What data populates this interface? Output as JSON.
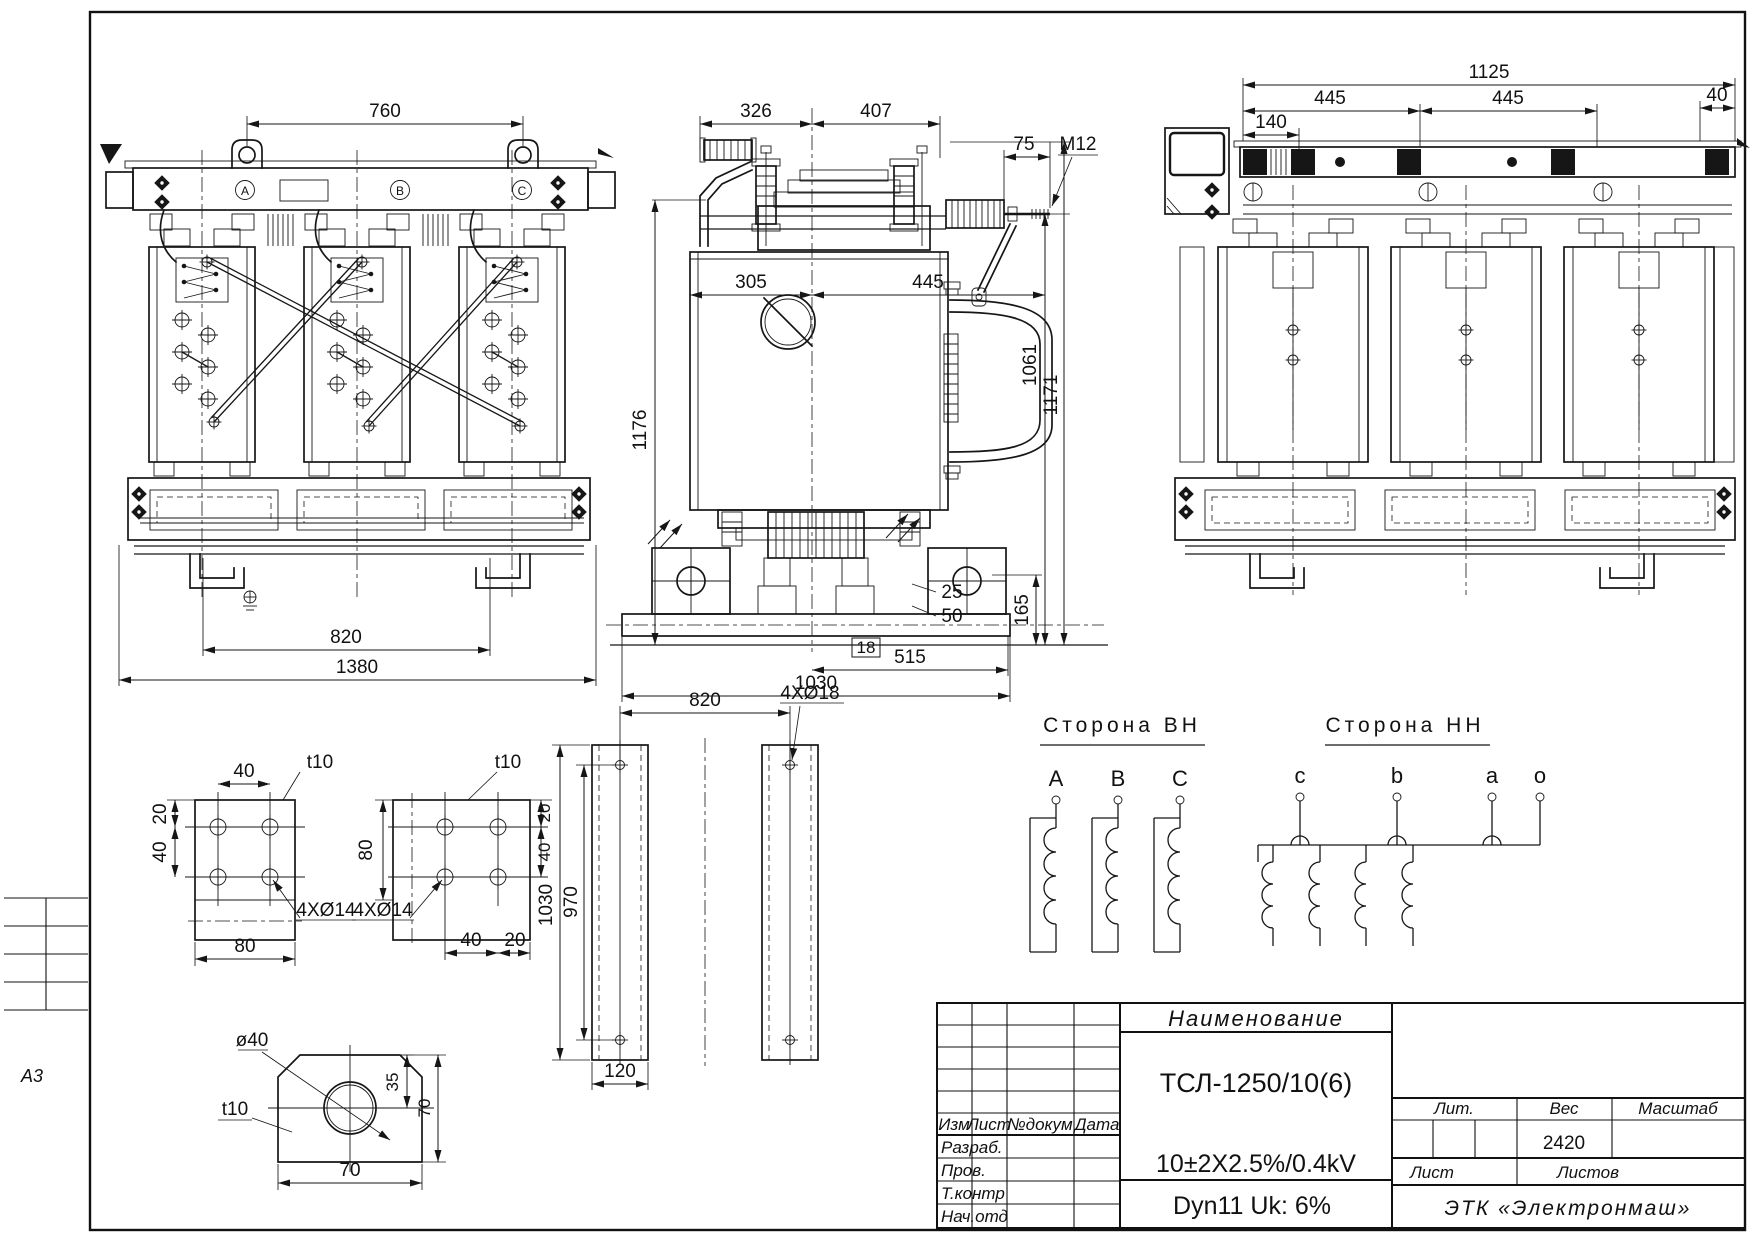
{
  "sheet": {
    "format": "А3"
  },
  "front_view": {
    "phases": [
      "A",
      "B",
      "C"
    ],
    "dims": {
      "lug_spacing": "760",
      "hole_spacing": "820",
      "overall_width": "1380"
    }
  },
  "side_view": {
    "dims": {
      "offset_left": "326",
      "offset_right": "407",
      "terminal_length": "75",
      "thread": "M12",
      "center_left": "305",
      "center_right": "445",
      "height": "1176",
      "height_to_terminal": "1061",
      "overall_height": "1171",
      "base_height": "165",
      "pad_a": "25",
      "pad_b": "50",
      "skid_thickness": "18",
      "half_base": "515",
      "base_length": "1030"
    }
  },
  "rear_view": {
    "dims": {
      "lug_span": "1125",
      "span_left": "445",
      "span_right": "445",
      "tap_offset": "140",
      "edge": "40"
    }
  },
  "details": {
    "plate_a": {
      "thickness": "t10",
      "hole_note": "4XØ14",
      "w_top": "40",
      "h1": "20",
      "h2": "40",
      "w_bottom": "80"
    },
    "plate_b": {
      "thickness": "t10",
      "hole_note": "4XØ14",
      "h_left": "80",
      "h1": "20",
      "h2": "40",
      "w1": "40",
      "w2": "20"
    },
    "bars": {
      "hole_note": "4XØ18",
      "hole_spacing": "820",
      "length": "1030",
      "hole_span": "970",
      "width": "120"
    },
    "gusset": {
      "hole": "ø40",
      "thickness": "t10",
      "offset": "35",
      "height": "70",
      "width": "70"
    }
  },
  "winding": {
    "hv": {
      "title": "Сторона ВН",
      "terminals": [
        "A",
        "B",
        "C"
      ]
    },
    "lv": {
      "title": "Сторона НН",
      "terminals": [
        "c",
        "b",
        "a",
        "o"
      ]
    }
  },
  "title_block": {
    "name_header": "Наименование",
    "model": "ТСЛ-1250/10(6)",
    "voltage": "10±2X2.5%/0.4kV",
    "group": "Dyn11 Uk: 6%",
    "col_izm": "Изм",
    "col_list": "Лист",
    "col_doc": "№докум",
    "col_date": "Дата",
    "row_dev": "Разраб.",
    "row_check": "Пров.",
    "row_tcontr": "Т.контр",
    "row_dept": "Нач.отд",
    "lit": "Лит.",
    "weight_label": "Вес",
    "scale_label": "Масштаб",
    "weight": "2420",
    "sheet_label": "Лист",
    "sheets_label": "Листов",
    "company": "ЭТК «Электронмаш»"
  }
}
